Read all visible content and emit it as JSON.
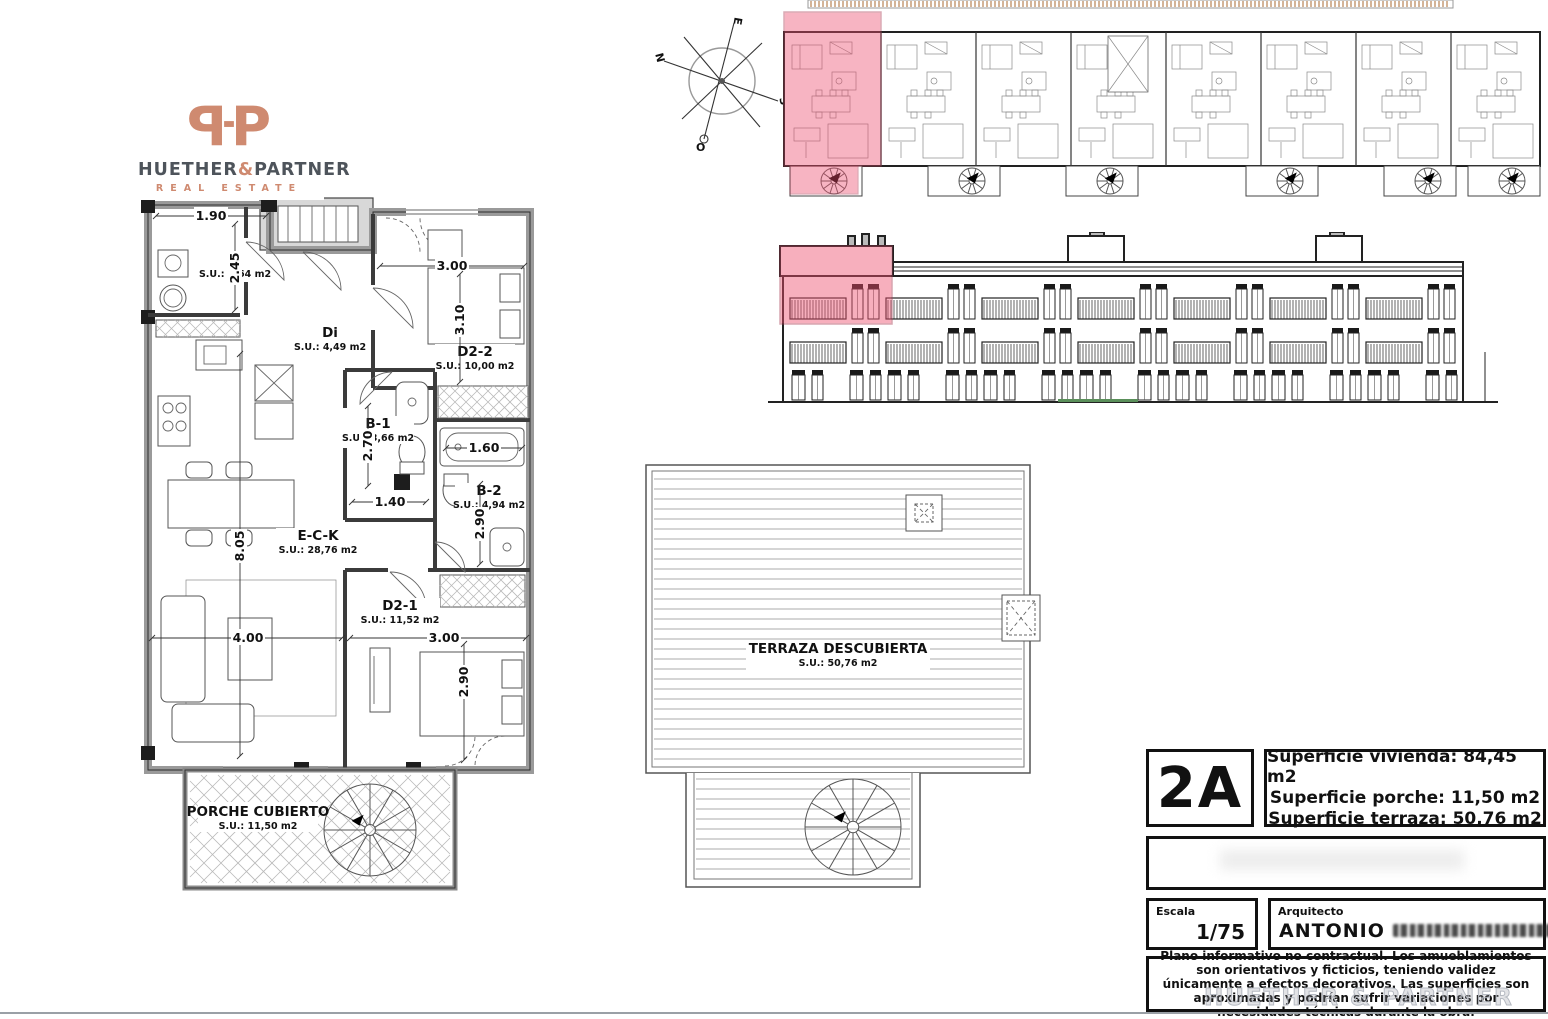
{
  "logo": {
    "mark": "P",
    "name_left": "HUETHER",
    "amp": "&",
    "name_right": "PARTNER",
    "tagline": "REAL ESTATE"
  },
  "compass": {
    "n": "N",
    "s": "S",
    "e": "E",
    "o": "O"
  },
  "floorplan": {
    "rooms": [
      {
        "label": "L",
        "area": "S.U.: 5,64 m2"
      },
      {
        "label": "Di",
        "area": "S.U.: 4,49 m2"
      },
      {
        "label": "D2-2",
        "area": "S.U.: 10,00 m2"
      },
      {
        "label": "B-1",
        "area": "S.U.: 3,66 m2"
      },
      {
        "label": "B-2",
        "area": "S.U.: 4,94 m2"
      },
      {
        "label": "E-C-K",
        "area": "S.U.: 28,76 m2"
      },
      {
        "label": "D2-1",
        "area": "S.U.: 11,52 m2"
      },
      {
        "label": "PORCHE CUBIERTO",
        "area": "S.U.: 11,50 m2"
      }
    ],
    "dims": {
      "top_w": "1.90",
      "l_h": "2.45",
      "d22_w": "3.00",
      "d22_h": "3.10",
      "b1_h": "2.70",
      "b1_w": "1.40",
      "b2_w": "1.60",
      "b2_h": "2.90",
      "eck_h": "8.05",
      "eck_w": "4.00",
      "d21_w": "3.00",
      "d21_h": "2.90"
    }
  },
  "terrace": {
    "label": "TERRAZA DESCUBIERTA",
    "area": "S.U.: 50,76 m2"
  },
  "titleblock": {
    "unit": "2A",
    "area_lines": [
      "Superficie vivienda: 84,45 m2",
      "Superficie porche: 11,50 m2",
      "Superficie terraza: 50,76 m2"
    ],
    "escala_label": "Escala",
    "escala_value": "1/75",
    "arquitecto_label": "Arquitecto",
    "arquitecto_value": "ANTONIO",
    "disclaimer": "Plano informativo no contractual. Los amueblamientos son orientativos y ficticios, teniendo validez únicamente a efectos decorativos. Las superficies son aproximadas y podrían sufrir variaciones por necesidades técnicas durante la obra."
  },
  "watermark": "HUETHER & PARTNER",
  "colors": {
    "highlight": "#ee4f6f",
    "highlight_line": "#a83a52",
    "logo_accent": "#cf8a70",
    "logo_text": "#4e545b",
    "hatch_tan": "#c9a27f"
  }
}
